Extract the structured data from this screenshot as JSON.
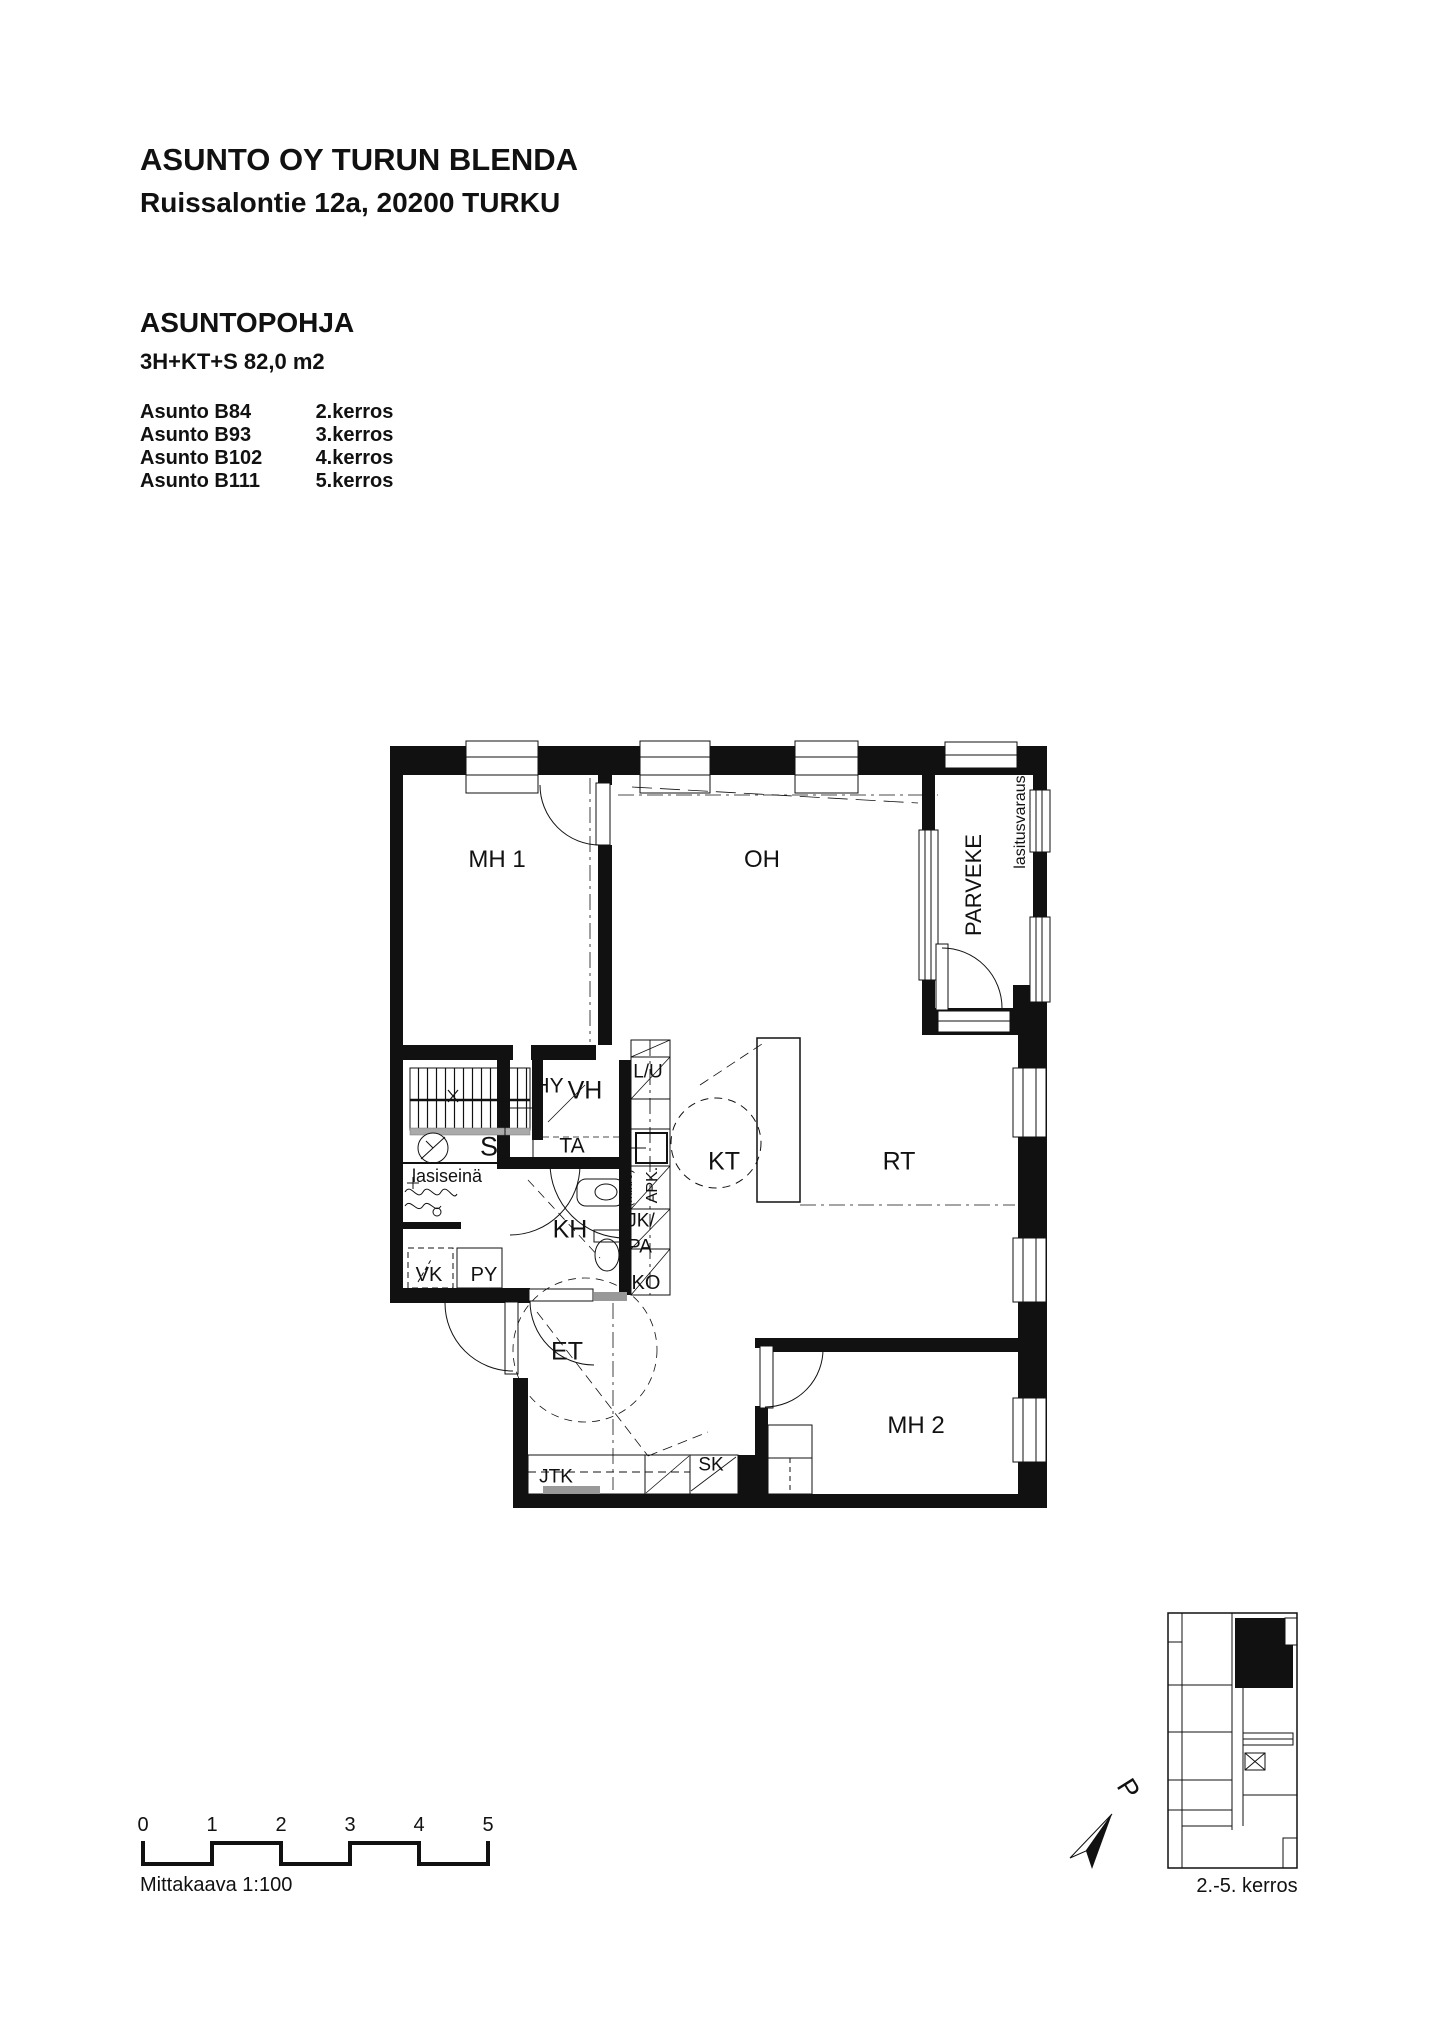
{
  "colors": {
    "ink": "#111111",
    "threshold_gray": "#999999",
    "bench_gray": "#aaaaaa"
  },
  "header": {
    "title": "ASUNTO OY TURUN BLENDA",
    "address": "Ruissalontie 12a, 20200 TURKU"
  },
  "section": {
    "heading": "ASUNTOPOHJA",
    "apartment_type": "3H+KT+S 82,0 m2"
  },
  "apartments": [
    {
      "name": "Asunto B84",
      "floor": "2.kerros"
    },
    {
      "name": "Asunto B93",
      "floor": "3.kerros"
    },
    {
      "name": "Asunto B102",
      "floor": "4.kerros"
    },
    {
      "name": "Asunto B111",
      "floor": "5.kerros"
    }
  ],
  "plan": {
    "labels": {
      "mh1": "MH 1",
      "oh": "OH",
      "parveke": "PARVEKE",
      "lasitusvaraus": "lasitusvaraus",
      "hy": "HY",
      "vh": "VH",
      "lu": "L/U",
      "ta": "TA",
      "s": "S",
      "lasiseina": "lasiseinä",
      "kh": "KH",
      "vk": "VK",
      "py": "PY",
      "mikro": "(mikro)",
      "apk": "APK.",
      "jk": "JK/",
      "pa": "PA",
      "ko": "KO",
      "kt": "KT",
      "rt": "RT",
      "et": "ET",
      "jtk": "JTK",
      "sk": "SK",
      "mh2": "MH 2"
    }
  },
  "scalebar": {
    "ticks": [
      "0",
      "1",
      "2",
      "3",
      "4",
      "5"
    ],
    "label": "Mittakaava 1:100"
  },
  "keyplan": {
    "floors_label": "2.-5. kerros",
    "north_letter": "P"
  }
}
